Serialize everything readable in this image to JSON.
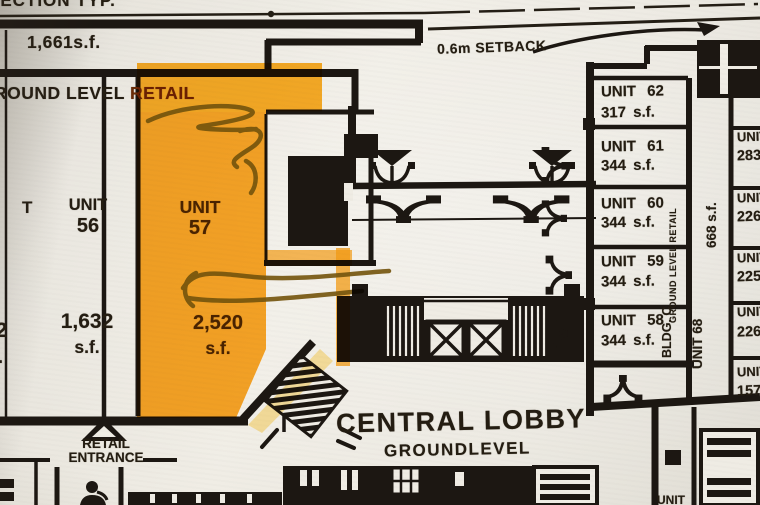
{
  "colors": {
    "paper": "#efece4",
    "ink": "#1c1712",
    "highlight": "#ffa416",
    "marker": "#7a590d"
  },
  "header": {
    "section_label": "SECTION TYP.",
    "area_top_left": "1,661s.f.",
    "retail_band_left": "ROUND LEVEL",
    "retail_band_right": "RETAIL",
    "setback_label": "0.6m SETBACK"
  },
  "west_units": {
    "partial_label": "T",
    "partial_area": "32",
    "partial_area_suffix": ".",
    "unit_56": {
      "label": "UNIT",
      "number": "56",
      "area": "1,632",
      "suffix": "s.f."
    },
    "unit_57": {
      "label": "UNIT",
      "number": "57",
      "area": "2,520",
      "suffix": "s.f."
    }
  },
  "building_c": {
    "vertical_retail_label": "GROUND LEVEL RETAIL",
    "vertical_bldg_label": "BLDG. C",
    "units": [
      {
        "name": "UNIT 62",
        "area": "317 s.f."
      },
      {
        "name": "UNIT 61",
        "area": "344 s.f."
      },
      {
        "name": "UNIT 60",
        "area": "344 s.f."
      },
      {
        "name": "UNIT 59",
        "area": "344 s.f."
      },
      {
        "name": "UNIT 58",
        "area": "344 s.f."
      }
    ]
  },
  "unit_68": {
    "name": "UNIT 68",
    "area": "668 s.f."
  },
  "east_units": [
    {
      "name": "UNIT",
      "area": "283"
    },
    {
      "name": "UNIT",
      "area": "226"
    },
    {
      "name": "UNIT",
      "area": "225"
    },
    {
      "name": "UNIT",
      "area": "226 s"
    },
    {
      "name": "UNIT",
      "area": "157 s"
    }
  ],
  "lobby": {
    "title": "CENTRAL LOBBY",
    "subtitle": "GROUNDLEVEL"
  },
  "entrance": {
    "line1": "RETAIL",
    "line2": "ENTRANCE"
  },
  "bottom_right_partial_label": "UNIT"
}
